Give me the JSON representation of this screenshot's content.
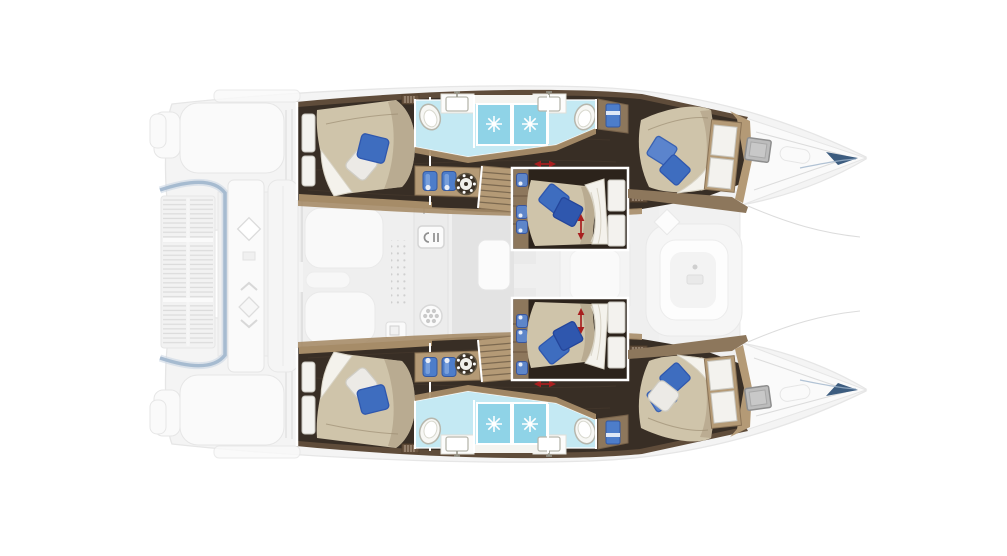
{
  "meta": {
    "title": "Catamaran 6-cabin deck plan",
    "description": "Top-down yacht layout drawing, bow pointing right. Six double cabins and four bathrooms in the two hulls are drawn in full colour; the saloon, cockpit, swim platform and foredeck are greyed out."
  },
  "colors": {
    "ghost_fill": "#f4f4f4",
    "ghost_stroke": "#e6e6e6",
    "ghost_white": "#fafafa",
    "ghost_line": "#dcdcdc",
    "ghost_blue": "#a3b8cf",
    "ghost_blue_soft": "#c6d3e2",
    "hull_wood": "#5f4c3a",
    "cabin_floor": "#382e25",
    "cabin_floor_dark": "#2c231b",
    "plank": "#46392c",
    "wood": "#a68c68",
    "wood_mid": "#8d775c",
    "wood_light": "#b49a76",
    "wood_dark": "#6a5440",
    "bed": "#cfc4aa",
    "bed_shade": "#b2a388",
    "bed_line": "#96876c",
    "duvet": "#f4f2ec",
    "duvet_shade": "#d9d4c6",
    "panel_fill": "#f3f2ee",
    "panel_stroke": "#c9c7bf",
    "pillow_blue": "#3e6dbf",
    "pillow_blue_dark": "#2f57ae",
    "pillow_blue_light": "#5b84cd",
    "pillow_white": "#eceae6",
    "bath_floor": "#c4e9f3",
    "shower": "#8fd3e7",
    "shower_deep": "#63c2dc",
    "fixture": "#f7f7f4",
    "fixture_stroke": "#b7b7ad",
    "towel": "#4d7dca",
    "washer": "#3b3227",
    "arrow_red": "#a81f1f",
    "hatch": "#bcbcbc",
    "hatch_stroke": "#8e8e8e",
    "navy": "#2b4e74"
  },
  "plan": {
    "orientation": "Top-down catamaran deck plan, bow to the right",
    "port_hull": {
      "label": "Port hull (top)",
      "areas": [
        {
          "name": "Aft double cabin"
        },
        {
          "name": "Aft bathroom with toilet, washbasin and shower"
        },
        {
          "name": "Forward bathroom with toilet, washbasin and shower"
        },
        {
          "name": "Companionway stairs"
        },
        {
          "name": "Corridor with round appliance and storage jugs"
        },
        {
          "name": "Midship double cabin with convertible berth (red arrows)"
        },
        {
          "name": "Forward double cabin"
        },
        {
          "name": "Bow deck with escape hatch"
        }
      ]
    },
    "starboard_hull": {
      "label": "Starboard hull (bottom)",
      "note": "Mirror image of the port hull; forward cabin has one blue and one white pillow"
    },
    "center": {
      "label": "Bridgedeck (greyed out)",
      "areas": [
        {
          "name": "Swim platform with teak slats"
        },
        {
          "name": "Aft cockpit seating and tables"
        },
        {
          "name": "Saloon lounge and table"
        },
        {
          "name": "Galley with sink and stove"
        },
        {
          "name": "Forward cockpit lounge"
        },
        {
          "name": "Foredeck between bows"
        }
      ]
    }
  },
  "counts": {
    "double_cabins": 6,
    "bathrooms": 4,
    "shower_stalls": 4,
    "toilets": 4,
    "washbasins": 4,
    "companionway_stairs": 2,
    "round_appliances": 2,
    "deck_hatches": 2,
    "red_convertible_arrows": 4,
    "blue_pillows": 9,
    "white_pillows": 3
  },
  "icons": [
    {
      "name": "shower-drain-icon",
      "meaning": "blue shower pan with white drain starburst"
    },
    {
      "name": "toilet-icon",
      "meaning": "white oval bowl"
    },
    {
      "name": "washbasin-icon",
      "meaning": "rectangular sink with faucet"
    },
    {
      "name": "washing-machine-icon",
      "meaning": "dark circle with white drum dots"
    },
    {
      "name": "storage-jugs-icon",
      "meaning": "two blue containers on wood counter"
    },
    {
      "name": "towel-icon",
      "meaning": "blue towel in cabinet"
    },
    {
      "name": "galley-sink-icon",
      "meaning": "sink with C-shaped faucet glyph"
    },
    {
      "name": "stove-burners-icon",
      "meaning": "circle with burner dots"
    },
    {
      "name": "bed-extension-arrow-icon",
      "meaning": "red double arrow marking sliding berth"
    },
    {
      "name": "deck-hatch-icon",
      "meaning": "grey square hatch on bow deck"
    },
    {
      "name": "stairs-icon",
      "meaning": "wooden steps down into hull"
    },
    {
      "name": "cockpit-table-icon",
      "meaning": "diamond table tops in cockpit"
    }
  ]
}
